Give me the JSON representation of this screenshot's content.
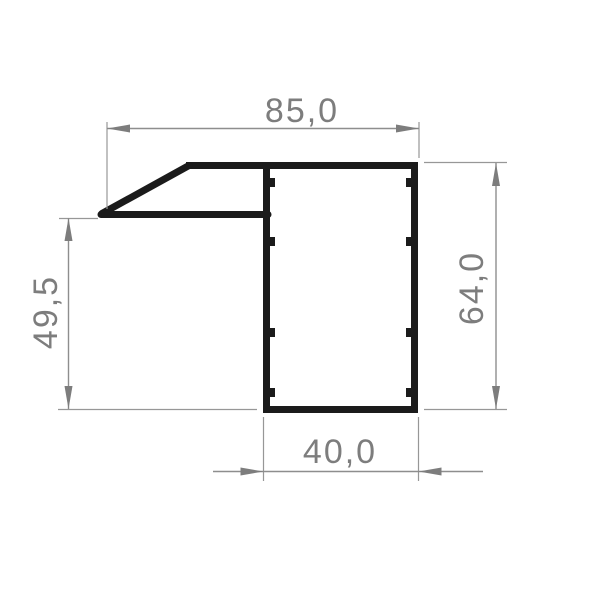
{
  "drawing": {
    "kind": "profile-cross-section-technical-drawing",
    "background_color": "#ffffff",
    "profile_color": "#1b1b1b",
    "dimension_line_color": "#8e8e8e",
    "dimension_text_color": "#7d7d7d",
    "dimensions": {
      "top_width": {
        "label": "85,0",
        "value": 85.0
      },
      "right_height": {
        "label": "64,0",
        "value": 64.0
      },
      "left_height": {
        "label": "49,5",
        "value": 49.5
      },
      "bottom_width": {
        "label": "40,0",
        "value": 40.0
      }
    }
  }
}
